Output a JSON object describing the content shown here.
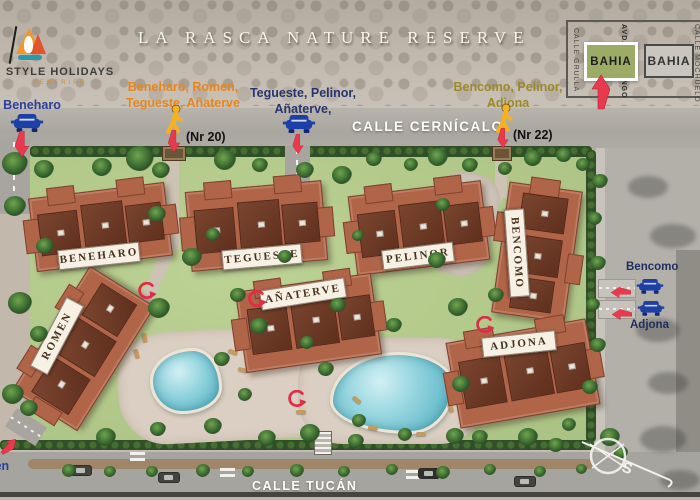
{
  "title": "LA RASCA NATURE RESERVE",
  "logo": {
    "name": "STYLE HOLIDAYS",
    "sub": "TENERIFE"
  },
  "minimap": {
    "streets": [
      "CALLE GRULLA",
      "AVDA. FLAMINGO",
      "CALLE MOCHUELO"
    ],
    "highlight_box": "BAHIA",
    "other_box": "BAHIA"
  },
  "roads": {
    "north": "CALLE CERNÍCALO",
    "south": "CALLE TUCÁN"
  },
  "entrances": {
    "beneharo_car": {
      "label": "Beneharo"
    },
    "nr20": {
      "line1": "Beneharo, Romen,",
      "line2": "Tegueste, Añaterve",
      "gate": "(Nr 20)"
    },
    "tegueste_car": {
      "line1": "Tegueste, Pelinor,",
      "line2": "Añaterve,"
    },
    "nr22": {
      "line1": "Bencomo, Pelinor,",
      "line2": "Adjona",
      "gate": "(Nr 22)"
    },
    "bencomo_car": {
      "label": "Bencomo"
    },
    "adjona_car": {
      "label": "Adjona"
    },
    "romen_car": {
      "label": "Romen"
    }
  },
  "buildings": [
    "BENEHARO",
    "TEGUESTE",
    "PELINOR",
    "BENCOMO",
    "ROMEN",
    "AÑATERVE",
    "ADJONA"
  ],
  "compass": {
    "south_label": "S"
  },
  "colors": {
    "accent_red": "#e83a4e",
    "car_blue": "#1d3fa6",
    "pedestrian_yellow": "#f4b223",
    "bahia_green": "#9cab66",
    "label_orange": "#e8861c",
    "label_olive": "#9c8a26",
    "label_blue": "#2c3f9a"
  }
}
